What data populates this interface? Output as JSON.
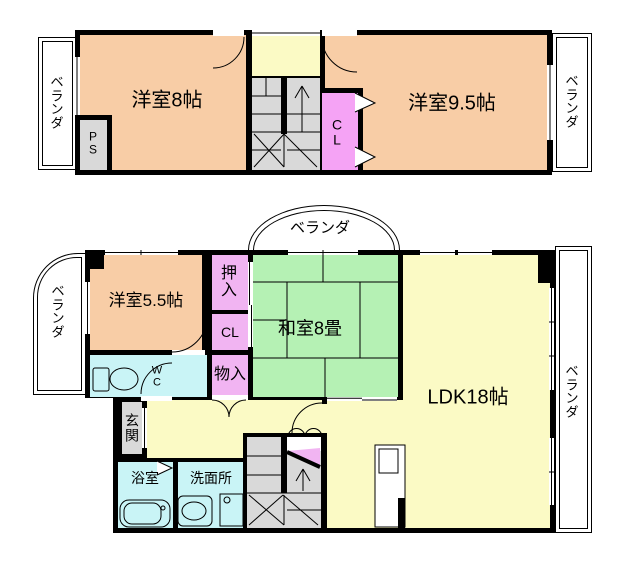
{
  "colors": {
    "wall": "#000000",
    "western_room": "#F8CDA6",
    "hall_ldk": "#FBFAC5",
    "closet_upper": "#F5A3F5",
    "closet_lower": "#F1B4F2",
    "tatami": "#B5F1B4",
    "wet_area": "#C9F4F6",
    "service": "#D9D9D9",
    "veranda": "#FFFFFF"
  },
  "upper": {
    "veranda_left": "ベランダ",
    "room_west_8": "洋室8帖",
    "ps": "PS",
    "closet": "CL",
    "room_west_95": "洋室9.5帖",
    "veranda_right": "ベランダ"
  },
  "lower": {
    "veranda_top": "ベランダ",
    "veranda_left": "ベランダ",
    "room_west_55": "洋室5.5帖",
    "oshiire": "押入",
    "closet": "CL",
    "storage": "物入",
    "washitsu": "和室8畳",
    "ldk": "LDK18帖",
    "wc": "WC",
    "genkan": "玄関",
    "bath": "浴室",
    "washroom": "洗面所",
    "veranda_right": "ベランダ"
  }
}
